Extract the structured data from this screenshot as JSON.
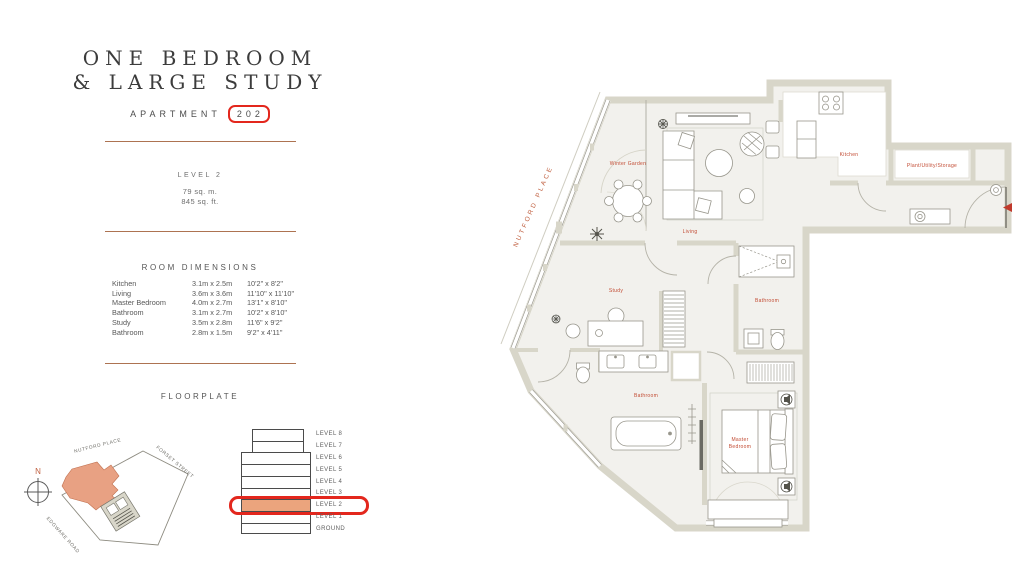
{
  "panel": {
    "title_line1": "ONE BEDROOM",
    "title_line2": "& LARGE STUDY",
    "apartment_label": "APARTMENT",
    "apartment_number": "202",
    "level": "LEVEL 2",
    "area_metric": "79 sq. m.",
    "area_imperial": "845 sq. ft.",
    "dimensions_heading": "ROOM DIMENSIONS",
    "rooms": [
      {
        "name": "Kitchen",
        "metric": "3.1m x 2.5m",
        "imperial": "10'2\" x 8'2\""
      },
      {
        "name": "Living",
        "metric": "3.6m x 3.6m",
        "imperial": "11'10\" x 11'10\""
      },
      {
        "name": "Master Bedroom",
        "metric": "4.0m x 2.7m",
        "imperial": "13'1\" x 8'10\""
      },
      {
        "name": "Bathroom",
        "metric": "3.1m x 2.7m",
        "imperial": "10'2\" x 8'10\""
      },
      {
        "name": "Study",
        "metric": "3.5m x 2.8m",
        "imperial": "11'6\" x 9'2\""
      },
      {
        "name": "Bathroom",
        "metric": "2.8m x 1.5m",
        "imperial": "9'2\" x 4'11\""
      }
    ],
    "floorplate_heading": "FLOORPLATE"
  },
  "site_map": {
    "north_label": "N",
    "streets": [
      "NUTFORD PLACE",
      "FORSET STREET",
      "EDGWARE ROAD"
    ]
  },
  "floorplate": {
    "levels": [
      "LEVEL 8",
      "LEVEL 7",
      "LEVEL 6",
      "LEVEL 5",
      "LEVEL 4",
      "LEVEL 3",
      "LEVEL 2",
      "LEVEL 1",
      "GROUND"
    ],
    "highlighted_level": "LEVEL 2"
  },
  "plan": {
    "street_label": "NUTFORD PLACE",
    "rooms": {
      "winter_garden": "Winter Garden",
      "living": "Living",
      "kitchen": "Kitchen",
      "plant": "Plant/Utility/Storage",
      "study": "Study",
      "bathroom_upper": "Bathroom",
      "bathroom_lower": "Bathroom",
      "master_line1": "Master",
      "master_line2": "Bedroom"
    }
  },
  "colors": {
    "accent_copper": "#ad7351",
    "highlight_red": "#e3271d",
    "highlight_orange": "#eba47d",
    "plan_label_orange": "#c24b33",
    "street_orange": "#c05f3f",
    "wall": "#d8d6c9",
    "floor": "#f2f1ed"
  }
}
